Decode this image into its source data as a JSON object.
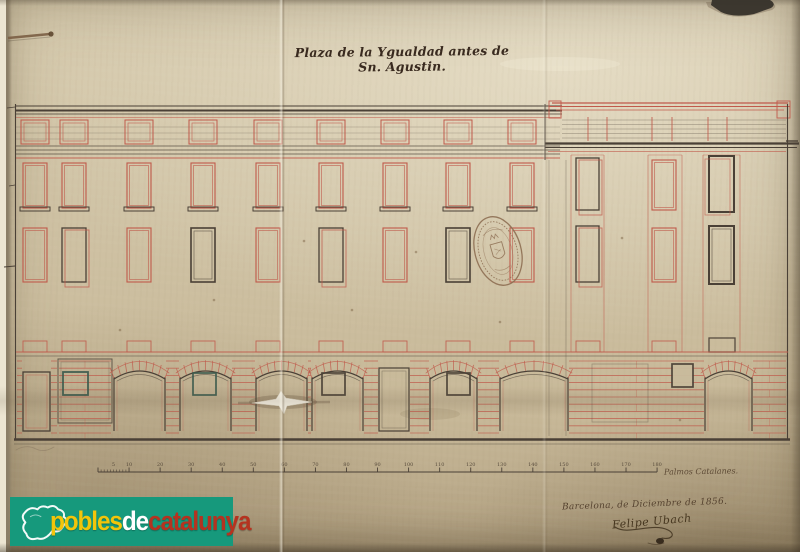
{
  "document": {
    "title": "Plaza de la Ygualdad antes de Sn. Agustin.",
    "place_date": "Barcelona, de Diciembre de 1856.",
    "signature": "Felipe Ubach"
  },
  "scale": {
    "unit_labels": [
      "5",
      "10",
      "20",
      "30",
      "40",
      "50",
      "60",
      "70",
      "80",
      "90",
      "100",
      "110",
      "120",
      "130",
      "140",
      "150",
      "160",
      "170",
      "180"
    ],
    "caption": "Palmos Catalanes."
  },
  "watermark": {
    "part1": "pobles",
    "part2": "de",
    "part3": "catalunya"
  },
  "colors": {
    "logo_green": "#16997c",
    "logo_yellow": "#f2c50a",
    "logo_red": "#b53320",
    "ink": "#4a4036",
    "ink_red": "#c05a4b",
    "ink_green": "#3d5c4e",
    "seal_brown": "#8d6e52",
    "paper": "#cfc2a4"
  }
}
